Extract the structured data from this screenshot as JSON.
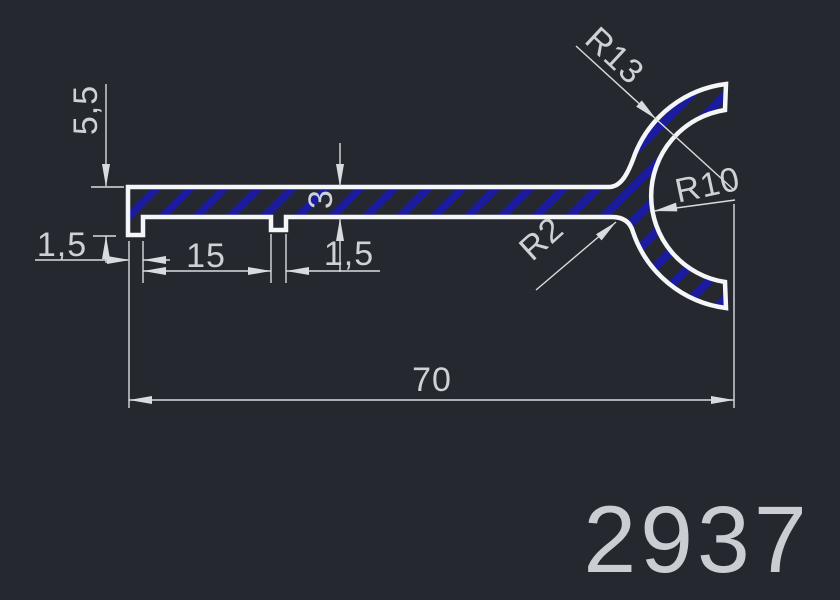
{
  "drawing": {
    "part_number": "2937",
    "dimensions": {
      "left_total_height": "5,5",
      "left_leg_width": "1,5",
      "leg_spacing": "15",
      "second_leg_width": "1,5",
      "wall_thickness": "3",
      "total_width": "70",
      "outer_radius": "R13",
      "inner_radius": "R10",
      "fillet_radius": "R2"
    },
    "colors": {
      "background": "#25282e",
      "profile_outline": "#f5f6f7",
      "hatch_blue": "#1b1ba0",
      "dimension_gray": "#d9dcdf",
      "text_gray": "#cdd2d6"
    }
  }
}
